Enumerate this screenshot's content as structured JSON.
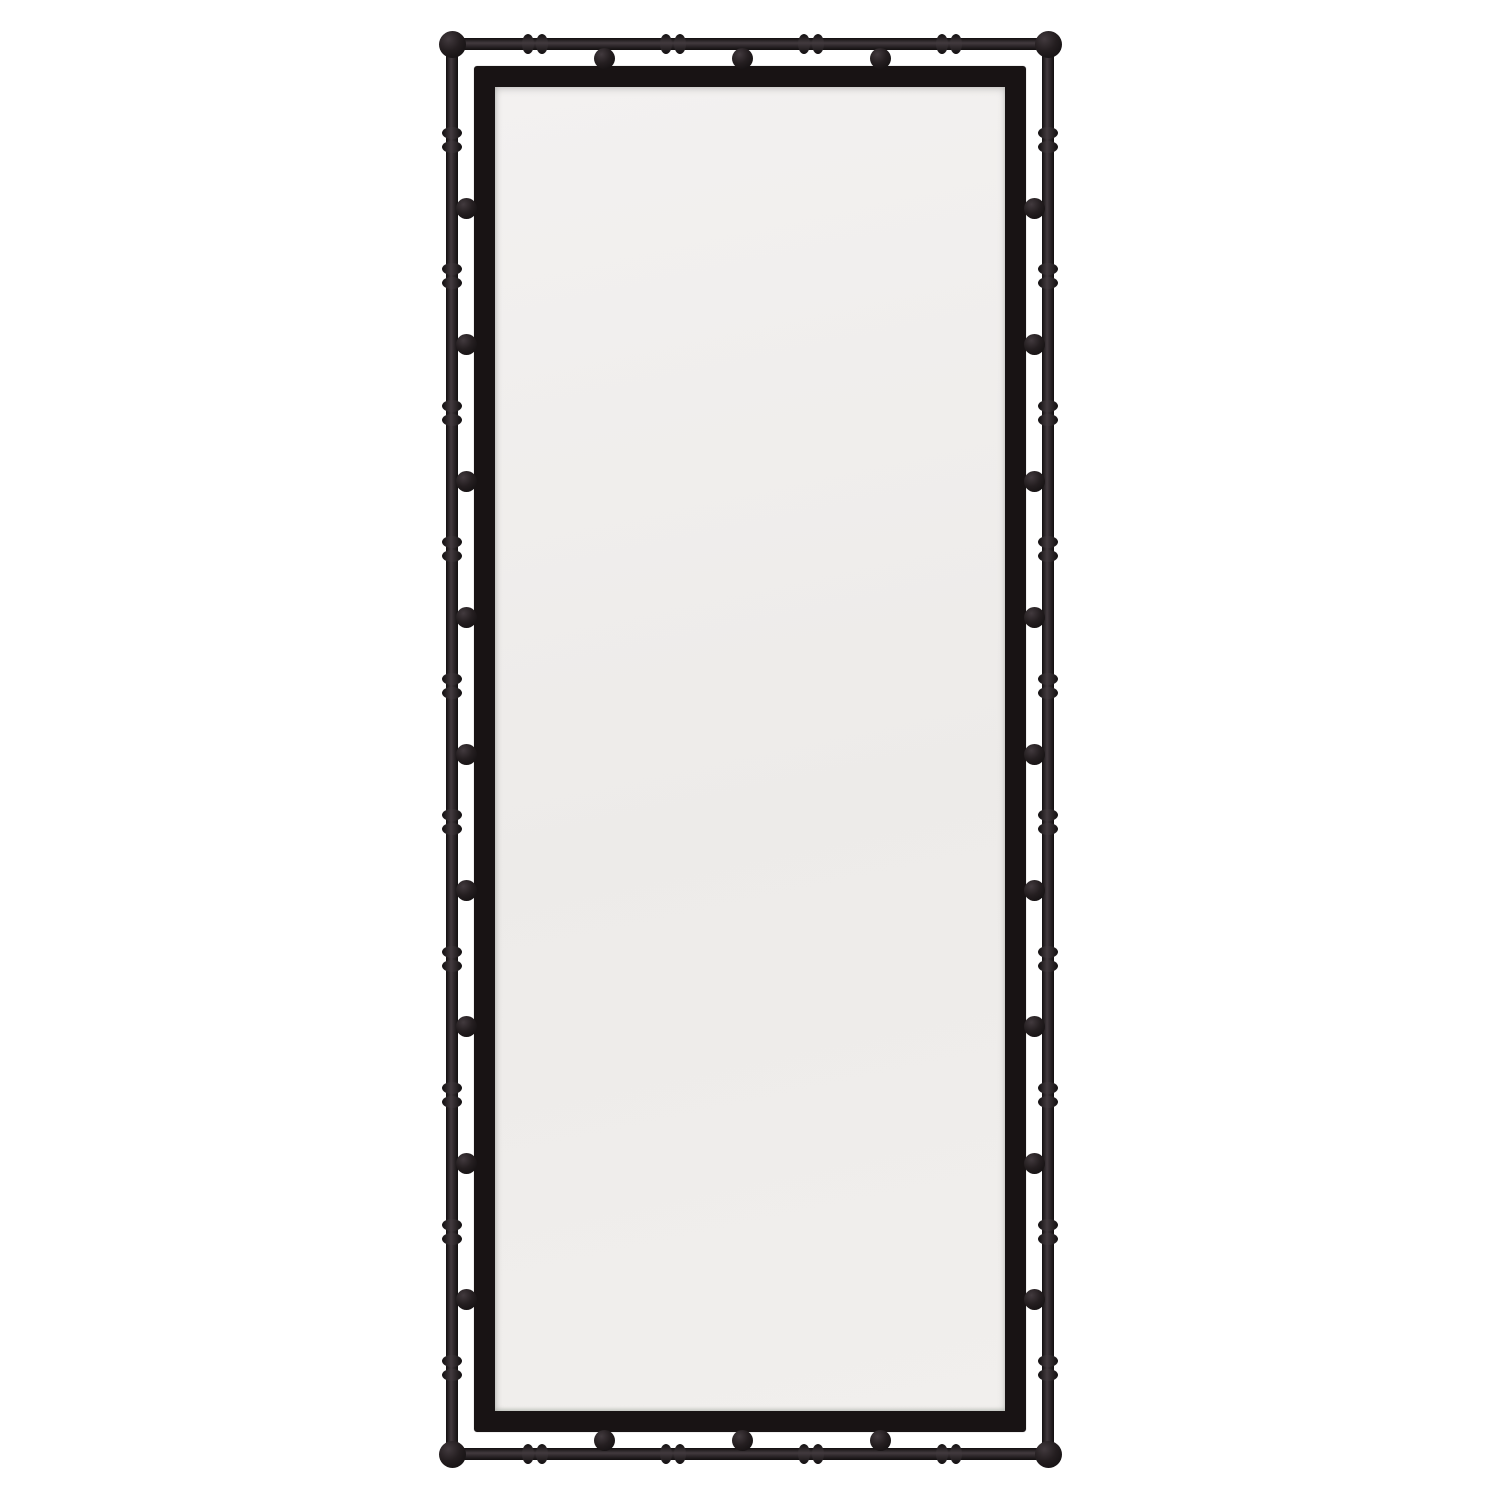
{
  "image": {
    "domain": "product-photo",
    "subject": "Blackened metal faux-bamboo rectangular mirror with spherical ball accents",
    "alt_text": "Tall rectangular floor mirror with a black faux-bamboo metal outer frame, bamboo knuckle rings, ball connectors and an inner solid black frame around pale mirror glass, photographed on a white background"
  },
  "mirror": {
    "colors": {
      "background": "#ffffff",
      "metal_dark": "#110e0f",
      "metal_mid": "#241e20",
      "metal_light": "#423a3e",
      "frame": "#181314",
      "glass_top": "#f3f1f0",
      "glass_mid": "#edebe9",
      "glass_bottom": "#f1efed"
    },
    "geometry": {
      "canvas": 1500,
      "tube": {
        "left": 452,
        "right": 1048,
        "top": 44,
        "bottom": 1454,
        "thickness": 12
      },
      "frame": {
        "left": 474,
        "top": 66,
        "right": 1026,
        "bottom": 1432,
        "border": 21
      },
      "ring": {
        "long": 26,
        "short": 20
      },
      "ball_diameter": 21,
      "corner_ball_diameter": 27,
      "ball_inset": 14,
      "side": {
        "ring_count": 10,
        "first": 140,
        "last": 1368,
        "ball_count": 9
      },
      "rail": {
        "ring_count": 4,
        "first": 535,
        "last": 949,
        "ball_count": 3
      }
    }
  }
}
